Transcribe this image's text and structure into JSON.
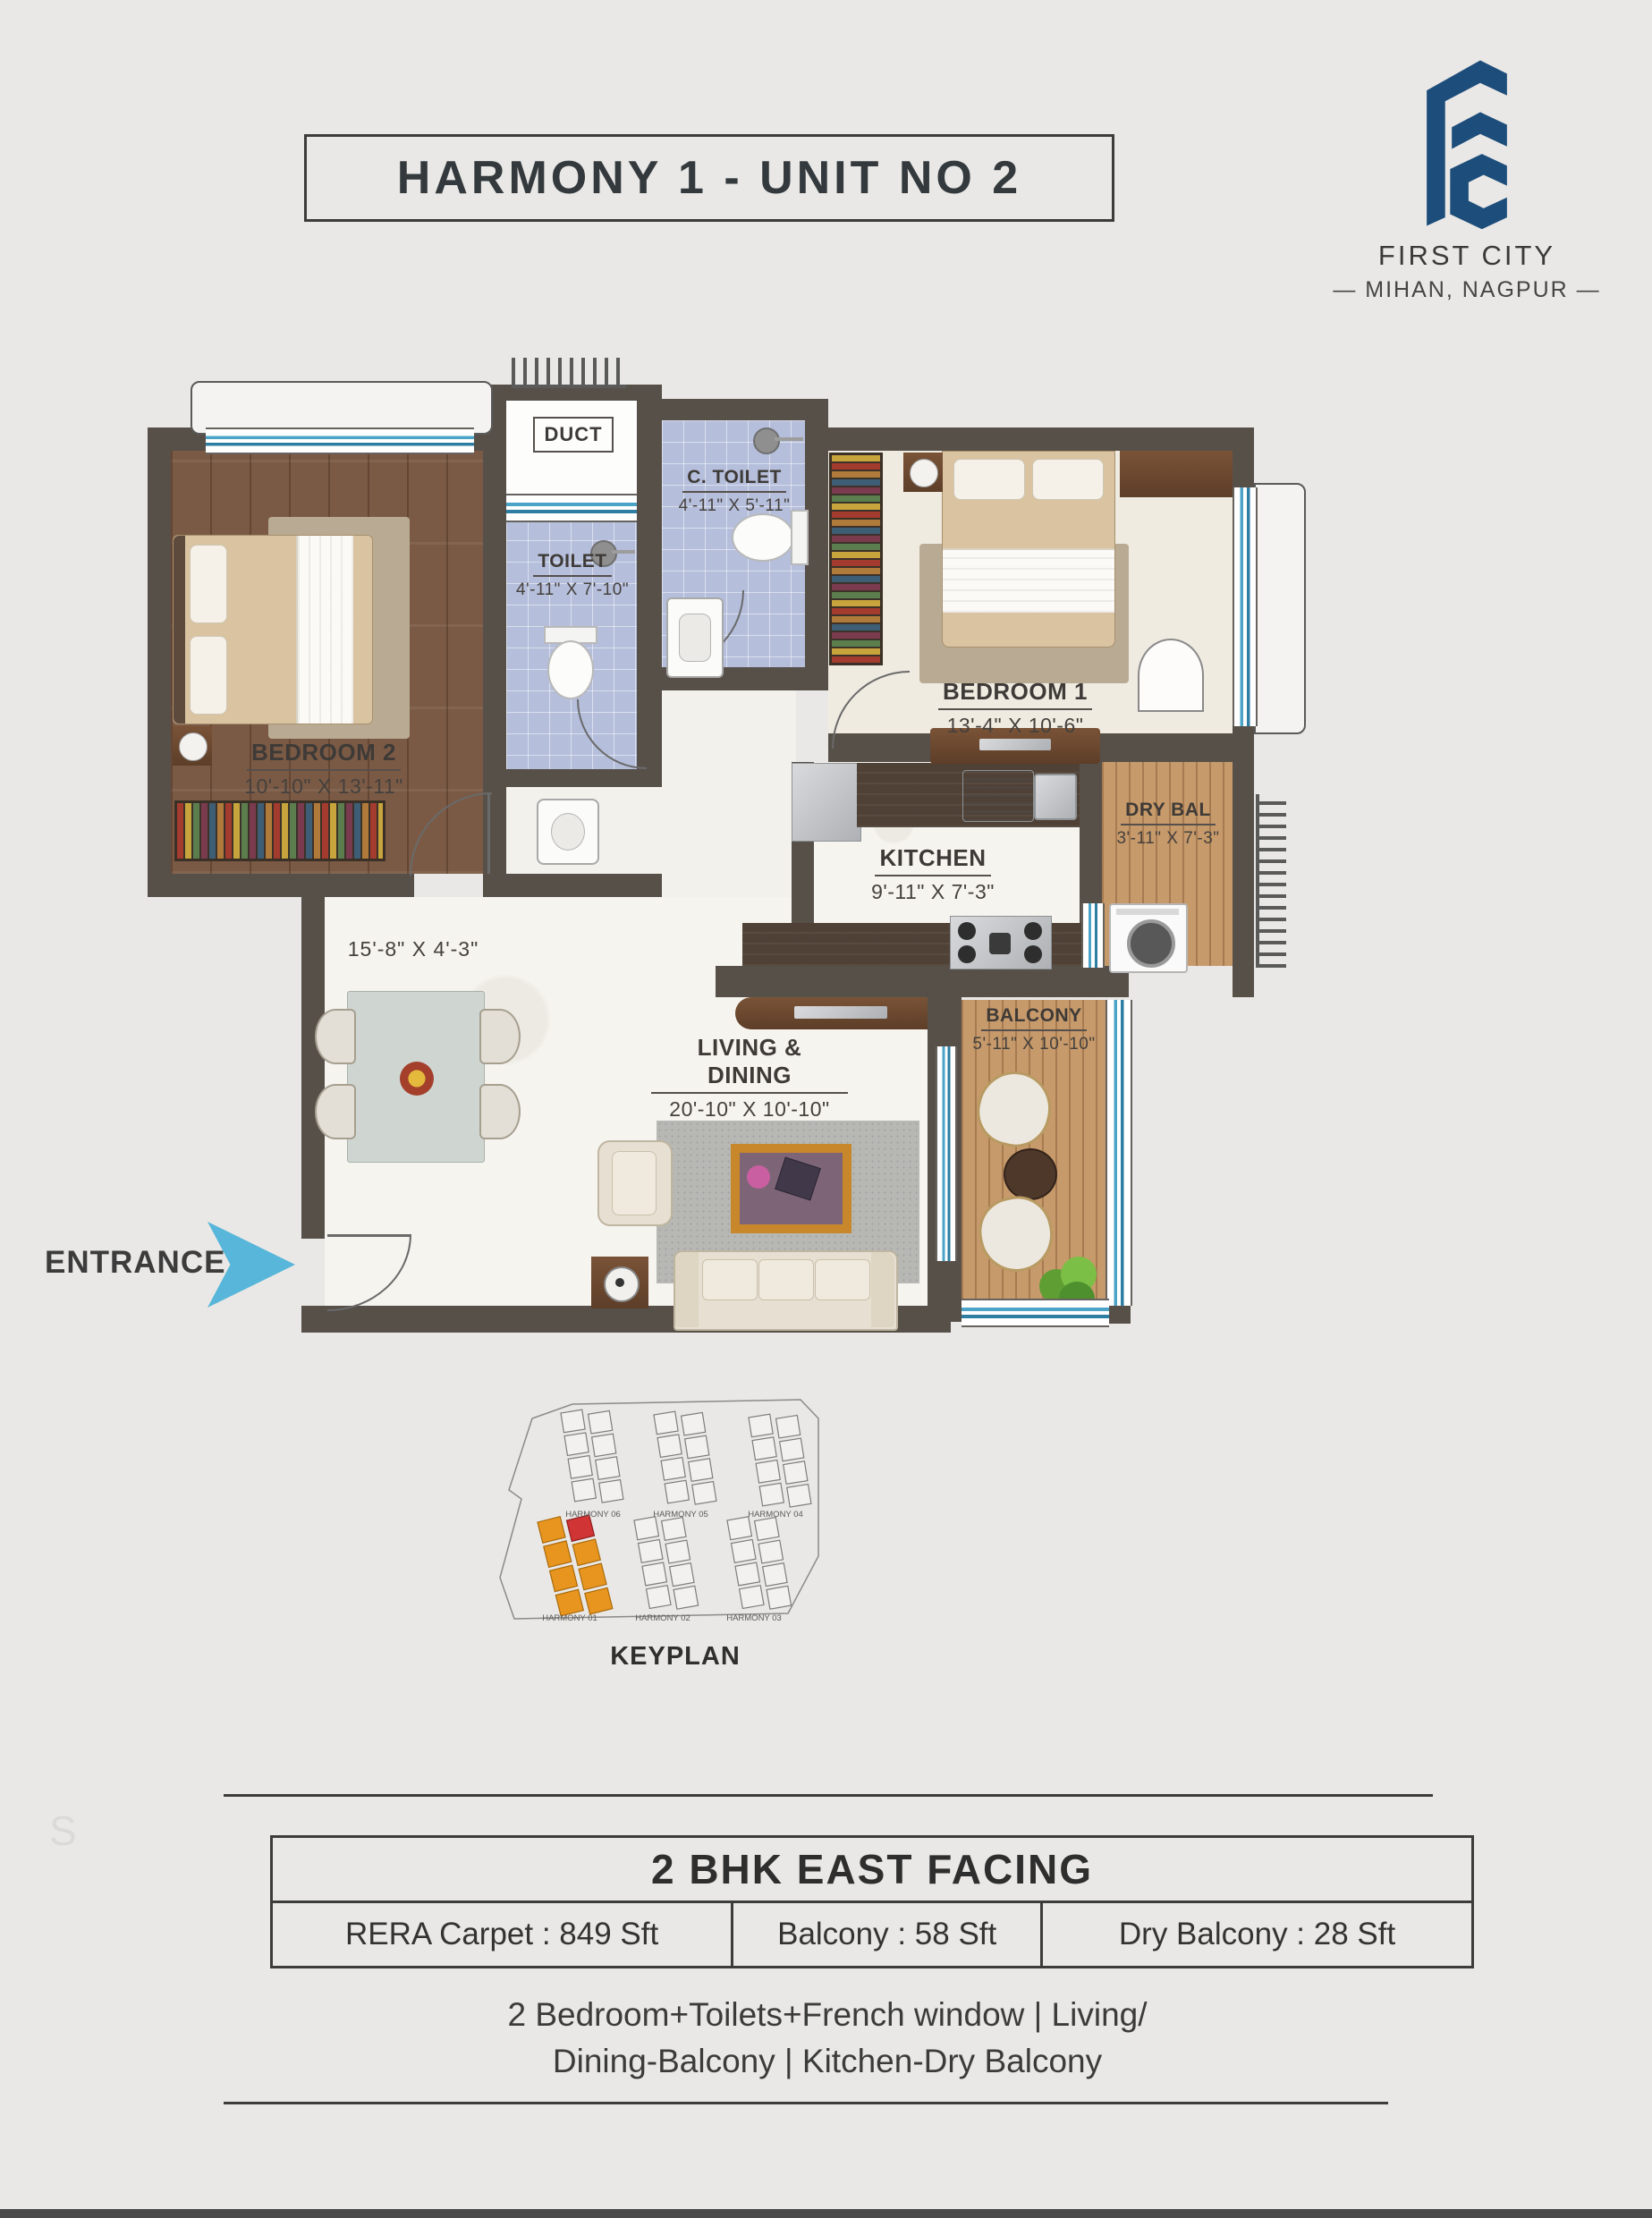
{
  "page": {
    "background": "#e9e8e6",
    "bottom_bar_color": "#4b4b4b",
    "watermark": "S"
  },
  "header": {
    "title": "HARMONY 1 - UNIT NO 2",
    "brand": {
      "name": "FIRST CITY",
      "location": "— MIHAN, NAGPUR —",
      "logo_color": "#1d4d7a"
    }
  },
  "floorplan": {
    "entrance_label": "ENTRANCE",
    "rooms": {
      "bedroom2": {
        "name": "BEDROOM 2",
        "dims": "10'-10\" X 13'-11\""
      },
      "toilet": {
        "name": "TOILET",
        "dims": "4'-11\" X 7'-10\""
      },
      "duct": {
        "name": "DUCT"
      },
      "c_toilet": {
        "name": "C. TOILET",
        "dims": "4'-11\" X 5'-11\""
      },
      "bedroom1": {
        "name": "BEDROOM 1",
        "dims": "13'-4\" X 10'-6\""
      },
      "kitchen": {
        "name": "KITCHEN",
        "dims": "9'-11\" X 7'-3\""
      },
      "dry_balcony": {
        "name": "DRY BAL",
        "dims": "3'-11\" X 7'-3\""
      },
      "living": {
        "name": "LIVING & DINING",
        "dims": "20'-10\" X 10'-10\""
      },
      "balcony": {
        "name": "BALCONY",
        "dims": "5'-11\" X 10'-10\""
      },
      "dining": {
        "dims": "15'-8\" X 4'-3\""
      }
    }
  },
  "keyplan": {
    "title": "KEYPLAN",
    "buildings": [
      "HARMONY 06",
      "HARMONY 05",
      "HARMONY 04",
      "HARMONY 01",
      "HARMONY 02",
      "HARMONY 03"
    ],
    "highlight_color": "#e8951f",
    "selected_unit_color": "#d13434"
  },
  "details": {
    "heading": "2 BHK EAST FACING",
    "specs": [
      "RERA Carpet : 849 Sft",
      "Balcony : 58 Sft",
      "Dry Balcony : 28 Sft"
    ],
    "description_line1": "2 Bedroom+Toilets+French window | Living/",
    "description_line2": "Dining-Balcony | Kitchen-Dry Balcony"
  }
}
